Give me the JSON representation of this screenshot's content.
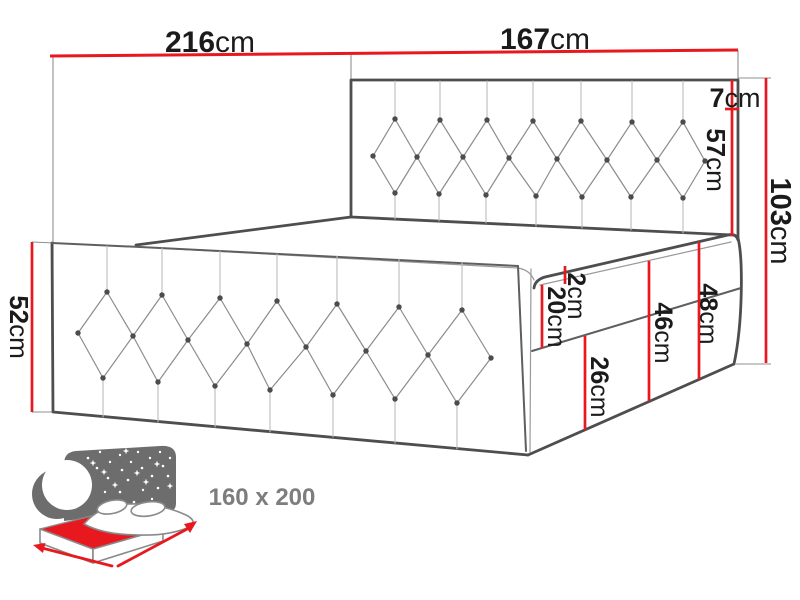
{
  "dims": {
    "d216": {
      "value": "216",
      "unit": "cm"
    },
    "d167": {
      "value": "167",
      "unit": "cm"
    },
    "d7": {
      "value": "7",
      "unit": "cm"
    },
    "d57": {
      "value": "57",
      "unit": "cm"
    },
    "d103": {
      "value": "103",
      "unit": "cm"
    },
    "d2": {
      "value": "2",
      "unit": "cm"
    },
    "d20": {
      "value": "20",
      "unit": "cm"
    },
    "d46": {
      "value": "46",
      "unit": "cm"
    },
    "d48": {
      "value": "48",
      "unit": "cm"
    },
    "d26": {
      "value": "26",
      "unit": "cm"
    },
    "d52": {
      "value": "52",
      "unit": "cm"
    }
  },
  "icon": {
    "size_label": "160 x 200"
  },
  "colors": {
    "dimension_red": "#e7191f",
    "outline_gray": "#4e4e4e",
    "icon_gray": "#6d6d6d",
    "icon_text_gray": "#7d7d7d",
    "label_black": "#1b1b1b",
    "background": "#ffffff"
  }
}
